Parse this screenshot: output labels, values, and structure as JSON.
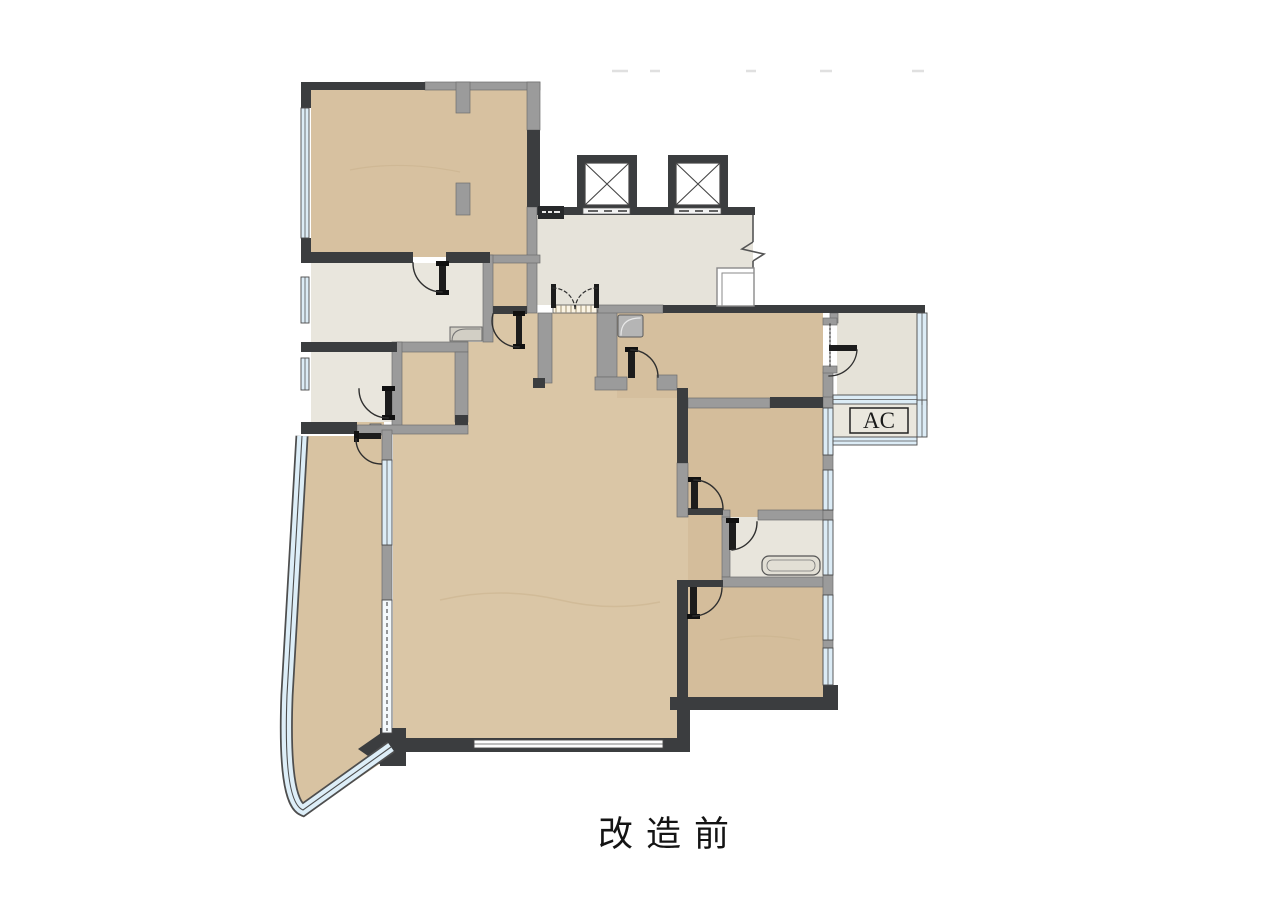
{
  "title": {
    "text": "改造前"
  },
  "plan": {
    "labels": {
      "ac": "AC"
    },
    "elevator_count": 2,
    "colors": {
      "background": "#ffffff",
      "wood_floor": "#d8c2a0",
      "stone_floor": "#e7e4da",
      "wall_dark": "#3b3d3f",
      "wall_gray": "#9b9b9b",
      "window_glass": "#dcecf6",
      "door_line": "#2f2f2f"
    }
  }
}
